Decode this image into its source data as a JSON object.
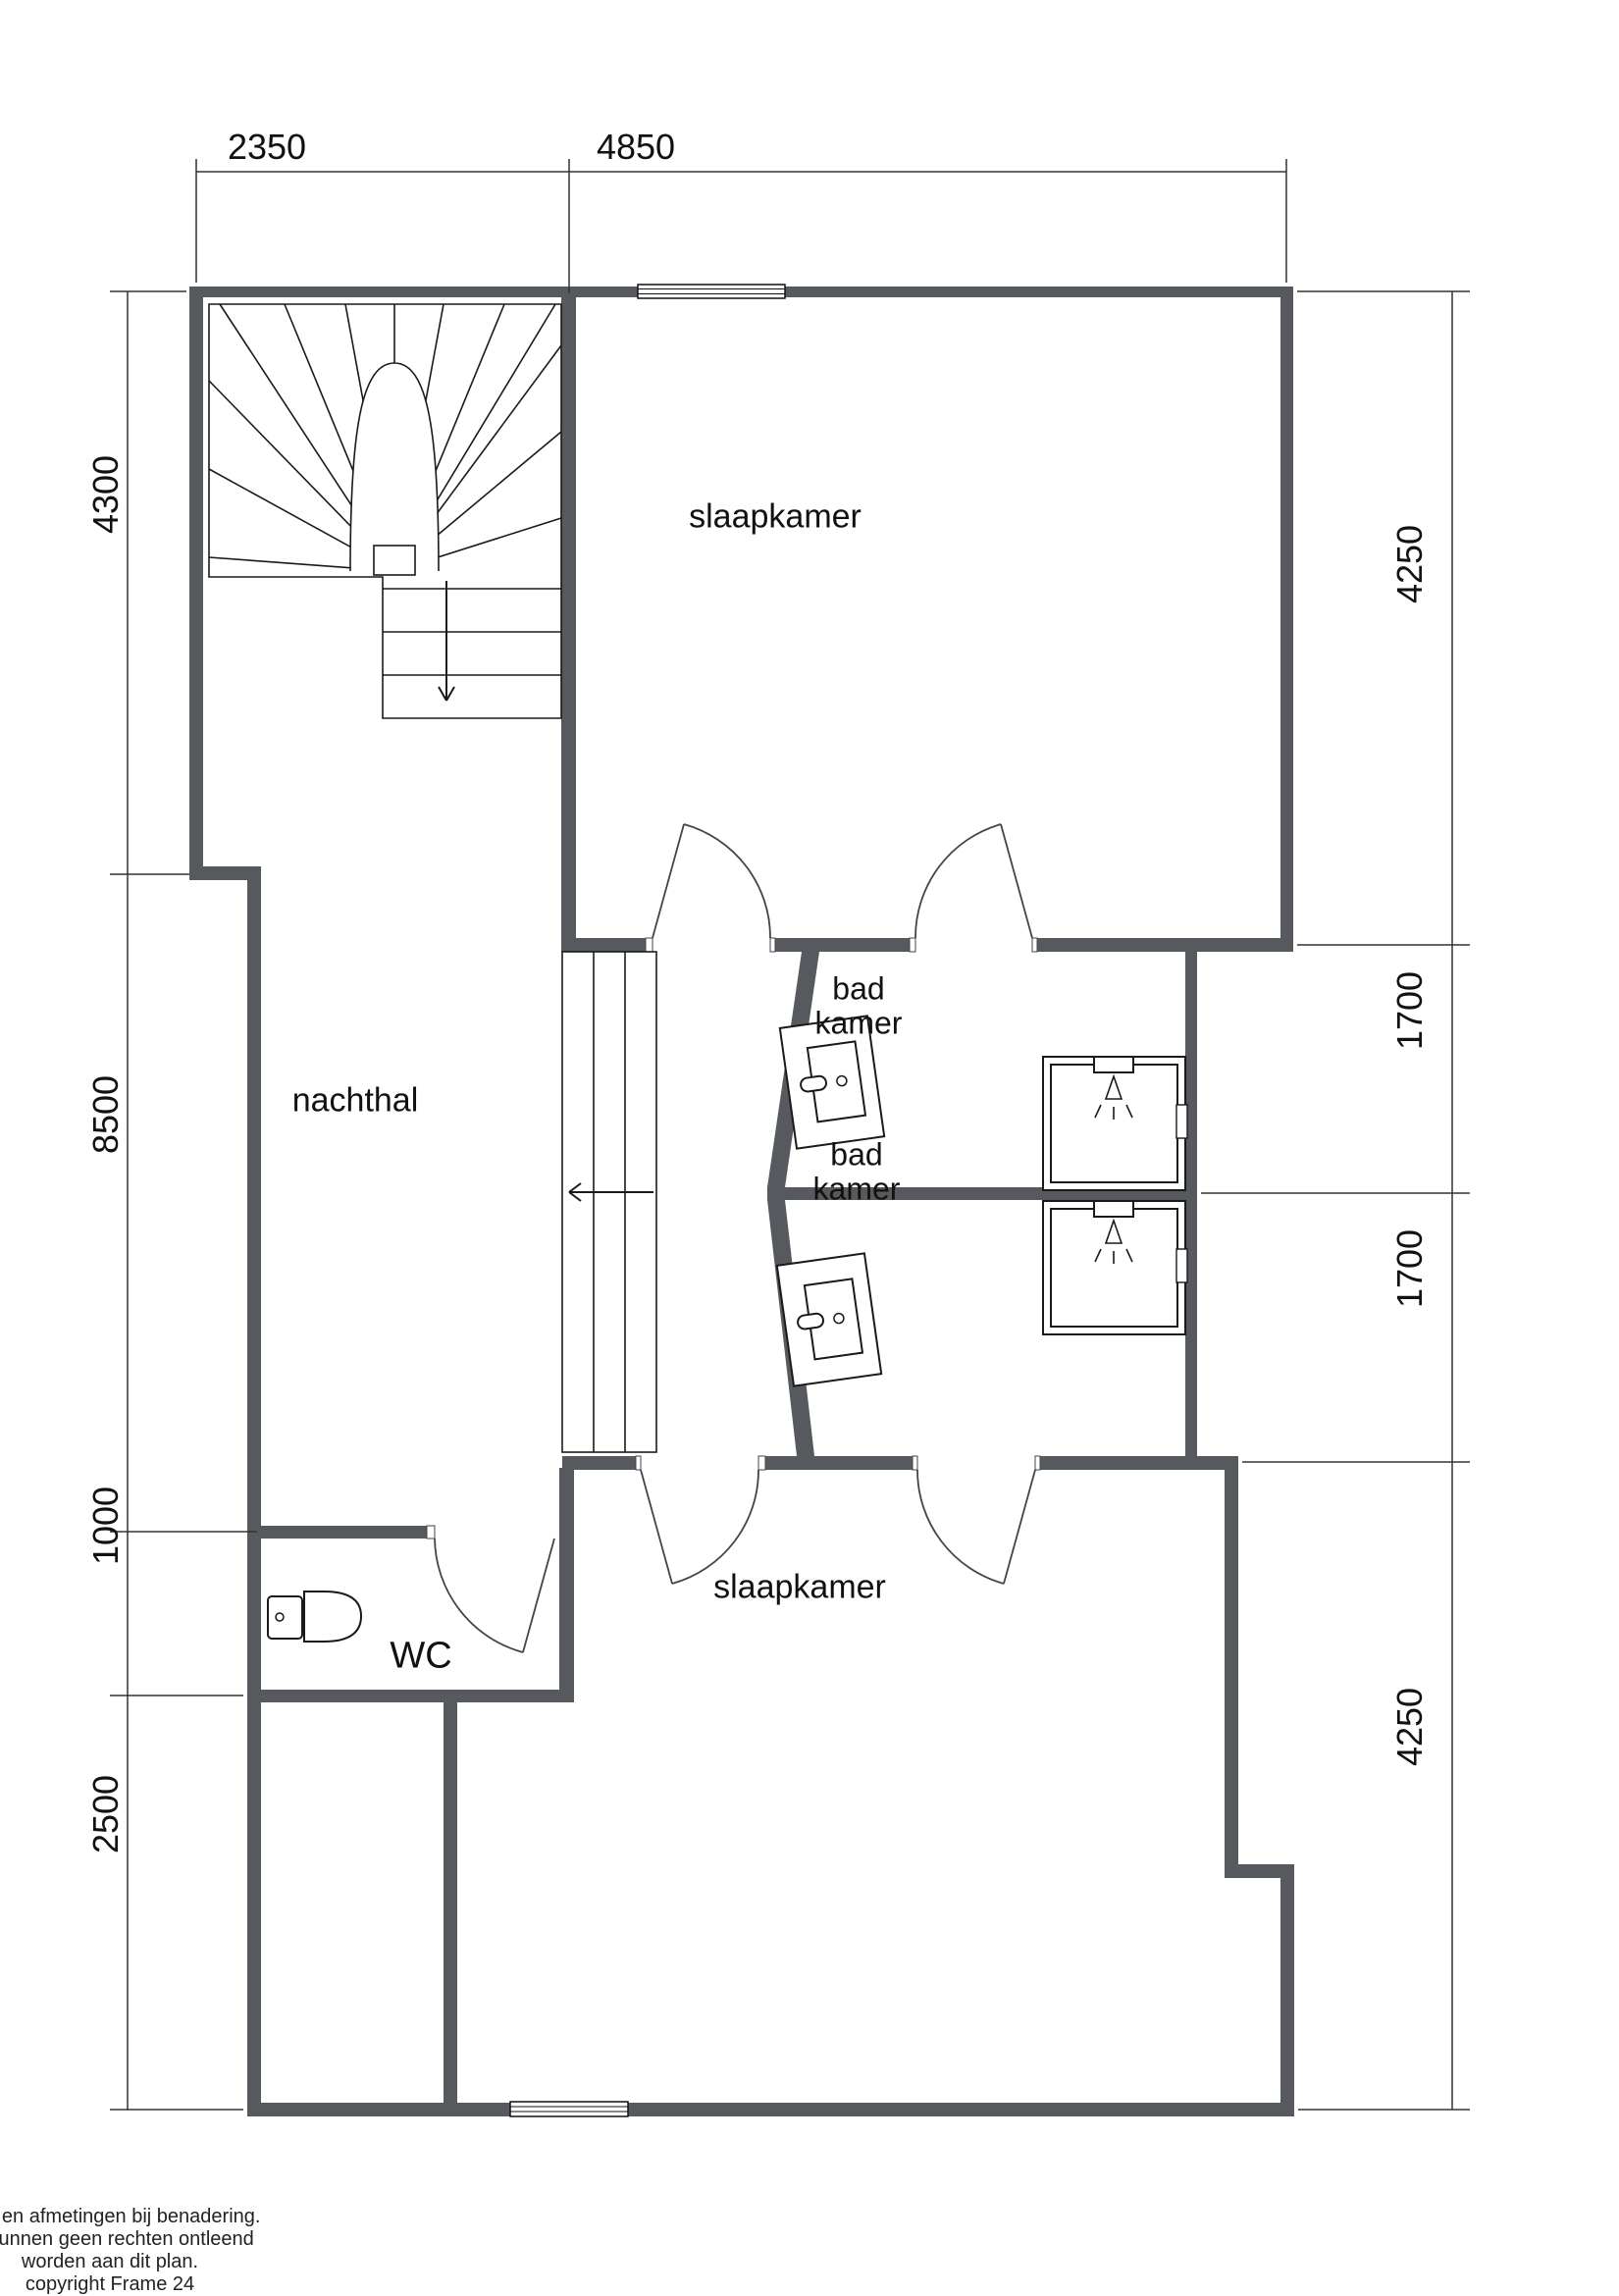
{
  "meta": {
    "type": "floor_plan",
    "background": "#ffffff",
    "wall_color": "#565a5f",
    "line_color": "#1a1a1a",
    "dim_color": "#333333"
  },
  "rooms": {
    "bedroom_top": "slaapkamer",
    "bedroom_bottom": "slaapkamer",
    "hallway": "nachthal",
    "bathroom_top_line1": "bad",
    "bathroom_top_line2": "kamer",
    "bathroom_bottom_line1": "bad",
    "bathroom_bottom_line2": "kamer",
    "wc": "WC"
  },
  "dimensions": {
    "top": {
      "d1": "2350",
      "d2": "4850"
    },
    "left": {
      "d1": "4300",
      "d2": "8500",
      "d3": "1000",
      "d4": "2500"
    },
    "right": {
      "d1": "4250",
      "d2": "1700",
      "d3": "1700",
      "d4": "4250"
    }
  },
  "footer": {
    "line1": "plan en afmetingen bij benadering.",
    "line2": "er kunnen geen rechten ontleend",
    "line3": "worden aan dit plan.",
    "line4": "copyright Frame 24"
  }
}
